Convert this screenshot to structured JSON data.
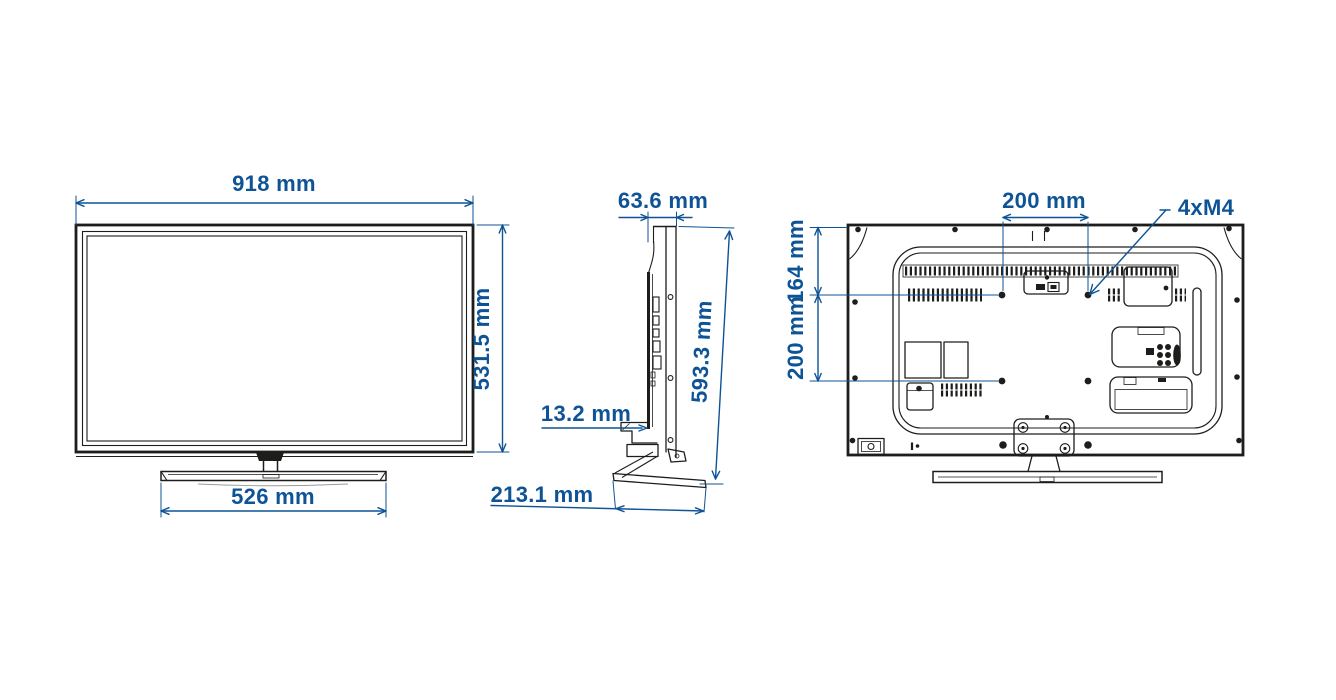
{
  "diagram": {
    "views": {
      "front": {
        "width": "918 mm",
        "height": "531.5 mm",
        "stand_width": "526 mm"
      },
      "side": {
        "depth": "63.6 mm",
        "height": "593.3 mm",
        "bottom_gap": "13.2 mm",
        "stand_depth": "213.1 mm"
      },
      "rear": {
        "vesa_width": "200 mm",
        "vesa_top_offset": "164 mm",
        "vesa_height": "200 mm",
        "mount_screws": "4xM4"
      }
    },
    "colors": {
      "dimension_blue": "#0d5396",
      "line_art": "#1d1d1b",
      "background": "#ffffff"
    }
  }
}
